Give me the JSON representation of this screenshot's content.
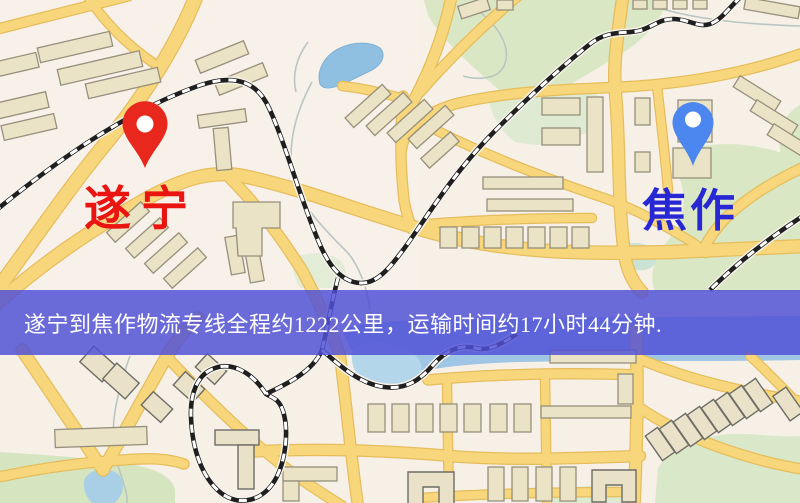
{
  "map": {
    "origin": {
      "label": "遂宁",
      "pin_color": "#e8271d",
      "label_color": "#ea1410"
    },
    "destination": {
      "label": "焦作",
      "pin_color": "#4c86ef",
      "label_color": "#2727d4"
    },
    "banner": {
      "text": "遂宁到焦作物流专线全程约1222公里，运输时间约17小时44分钟.",
      "background_color": "rgba(80,80,215,0.84)",
      "text_color": "#ffffff"
    },
    "route_summary": {
      "origin": "遂宁",
      "destination": "焦作",
      "distance_text": "约1222公里",
      "duration_text": "约17小时44分钟"
    }
  },
  "palette": {
    "background": "#f6f0e7",
    "road": "#f8d77c",
    "road_casing": "#e6bd5c",
    "building": "#ebe3c6",
    "green_area": "#d9e7c4",
    "water": "#8fc0e2",
    "railway_dark": "#1f1f1f"
  }
}
